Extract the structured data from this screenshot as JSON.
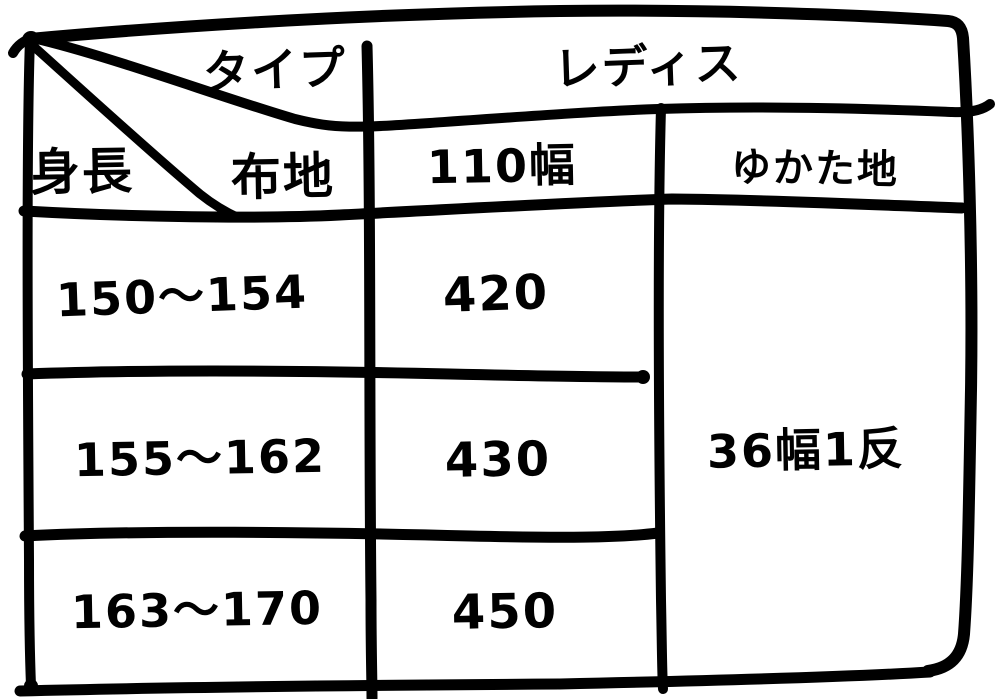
{
  "chart_data": {
    "type": "table",
    "corner": {
      "top": "タイプ",
      "middle": "布地",
      "left": "身長"
    },
    "group_header": "レディス",
    "col_headers": [
      "110幅",
      "ゆかた地"
    ],
    "rows": [
      {
        "height": "150〜154",
        "v110": "420"
      },
      {
        "height": "155〜162",
        "v110": "430"
      },
      {
        "height": "163〜170",
        "v110": "450"
      }
    ],
    "yukata_merged": "36幅1反",
    "layout": "hand-drawn table, diagonal split corner cell, right column merged across all data rows"
  },
  "colors": {
    "ink": "#000000",
    "background": "#ffffff"
  }
}
